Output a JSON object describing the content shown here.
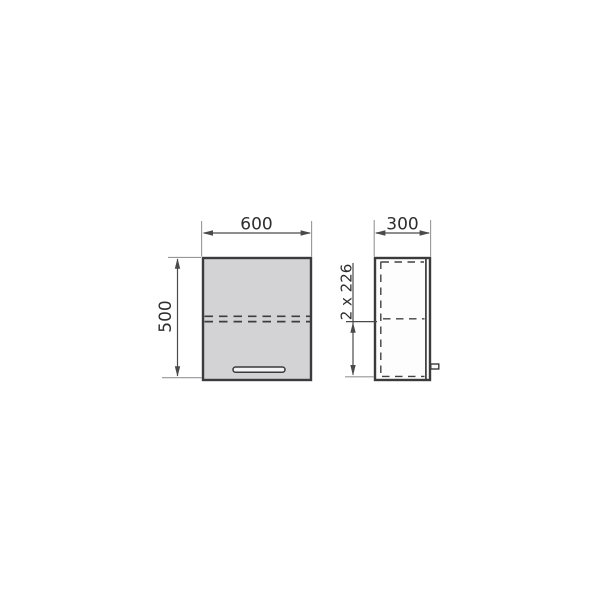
{
  "drawing": {
    "title": "wall-cabinet-dimension-drawing",
    "front_view": {
      "width_label": "600",
      "height_label": "500"
    },
    "side_view": {
      "depth_label": "300",
      "fold_sections_label": "2 x 226"
    },
    "colors": {
      "background": "#ffffff",
      "panel_fill": "#d3d3d5",
      "side_fill": "#fdfdfd",
      "outline": "#3b3b3d",
      "hidden_line": "#414144",
      "dim_line": "#4a4a4c",
      "ext_line": "#96969a",
      "text": "#2e2e30",
      "handle_fill": "#f3f3f4"
    }
  }
}
